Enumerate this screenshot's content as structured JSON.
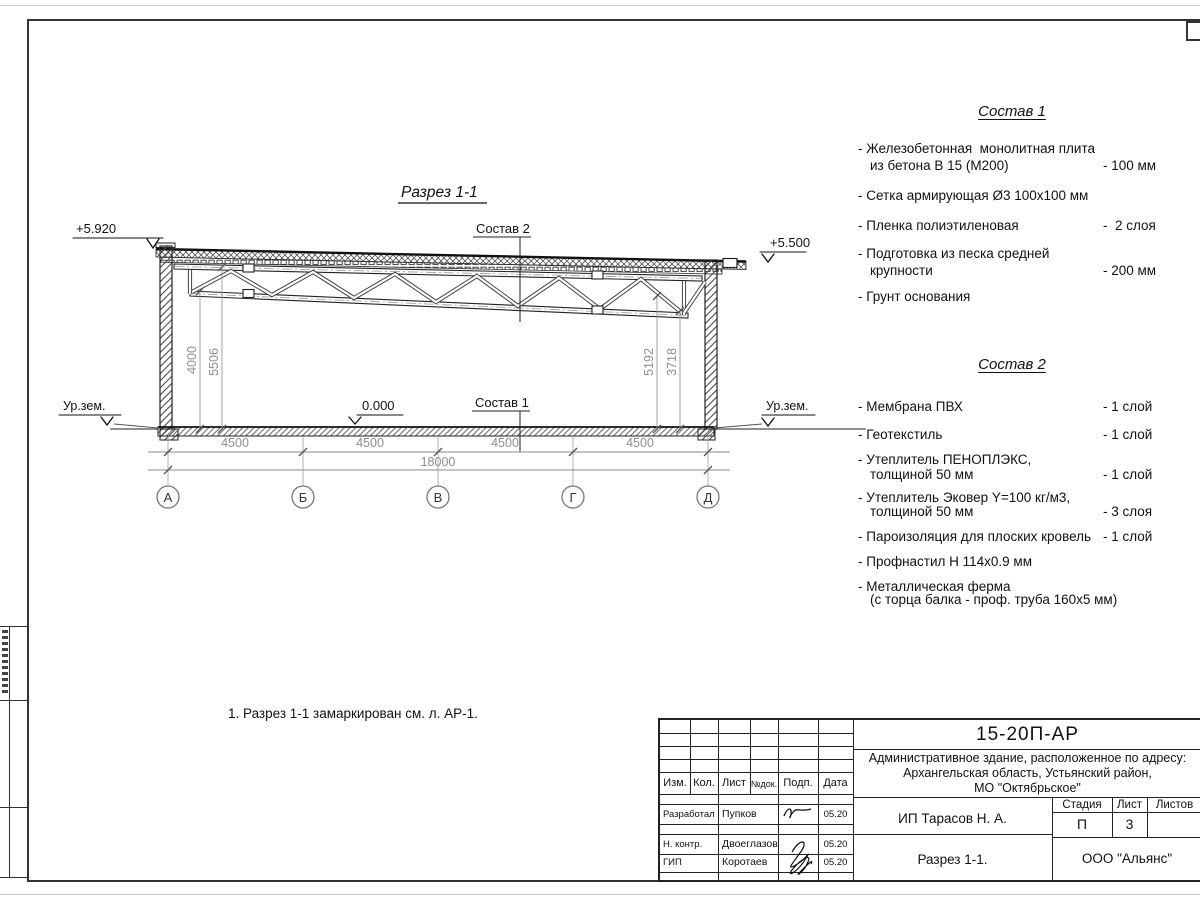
{
  "page": {
    "section_title": "Разрез 1-1",
    "note": "1. Разрез 1-1 замаркирован см. л. АР-1."
  },
  "section": {
    "elev_top_left": "+5.920",
    "elev_top_right": "+5.500",
    "elev_zero": "0.000",
    "ground_left": "Ур.зем.",
    "ground_right": "Ур.зем.",
    "label_sostav1": "Состав 1",
    "label_sostav2": "Состав 2",
    "spans": [
      "4500",
      "4500",
      "4500",
      "4500"
    ],
    "dim_total": "18000",
    "dims_left": [
      "4000",
      "5506"
    ],
    "dims_right": [
      "5192",
      "3718"
    ],
    "axes": [
      "А",
      "Б",
      "В",
      "Г",
      "Д"
    ]
  },
  "sostav1": {
    "title": "Состав 1",
    "items": [
      {
        "l1": "- Железобетонная  монолитная плита",
        "l2": "из бетона В 15 (М200)",
        "val": "- 100 мм"
      },
      {
        "l1": "- Сетка армирующая Ø3 100х100 мм",
        "l2": "",
        "val": ""
      },
      {
        "l1": "- Пленка полиэтиленовая",
        "l2": "",
        "val": "-  2 слоя"
      },
      {
        "l1": "- Подготовка из песка средней",
        "l2": "крупности",
        "val": "- 200 мм"
      },
      {
        "l1": "- Грунт основания",
        "l2": "",
        "val": ""
      }
    ]
  },
  "sostav2": {
    "title": "Состав 2",
    "items": [
      {
        "l1": "- Мембрана ПВХ",
        "l2": "",
        "val": "- 1 слой"
      },
      {
        "l1": "- Геотекстиль",
        "l2": "",
        "val": "- 1 слой"
      },
      {
        "l1": "- Утеплитель ПЕНОПЛЭКС,",
        "l2": "толщиной 50 мм",
        "val": "- 1 слой"
      },
      {
        "l1": "- Утеплитель Эковер Y=100 кг/м3,",
        "l2": "толщиной 50 мм",
        "val": "- 3 слоя"
      },
      {
        "l1": "- Пароизоляция для плоских кровель",
        "l2": "",
        "val": "- 1 слой"
      },
      {
        "l1": "- Профнастил Н 114х0.9 мм",
        "l2": "",
        "val": ""
      },
      {
        "l1": "- Металлическая ферма",
        "l2": "(с торца балка - проф. труба 160х5 мм)",
        "val": ""
      }
    ]
  },
  "titleblock": {
    "doc_number": "15-20П-АР",
    "address1": "Административное здание, расположенное по адресу:",
    "address2": "Архангельская область, Устьянский район,",
    "address3": "МО \"Октябрьское\"",
    "col_izm": "Изм.",
    "col_kol": "Кол.",
    "col_list": "Лист",
    "col_ndok": "№док.",
    "col_podp": "Подп.",
    "col_data": "Дата",
    "row1_role": "Разработал",
    "row1_name": "Пупков",
    "row1_date": "05.20",
    "row2_role": "Н. контр.",
    "row2_name": "Двоеглазов",
    "row2_date": "05.20",
    "row3_role": "ГИП",
    "row3_name": "Коротаев",
    "row3_date": "05.20",
    "client": "ИП Тарасов Н. А.",
    "stage_label": "Стадия",
    "sheet_label": "Лист",
    "sheets_label": "Листов",
    "stage": "П",
    "sheet": "3",
    "sheet_title": "Разрез 1-1.",
    "company": "ООО \"Альянс\""
  }
}
